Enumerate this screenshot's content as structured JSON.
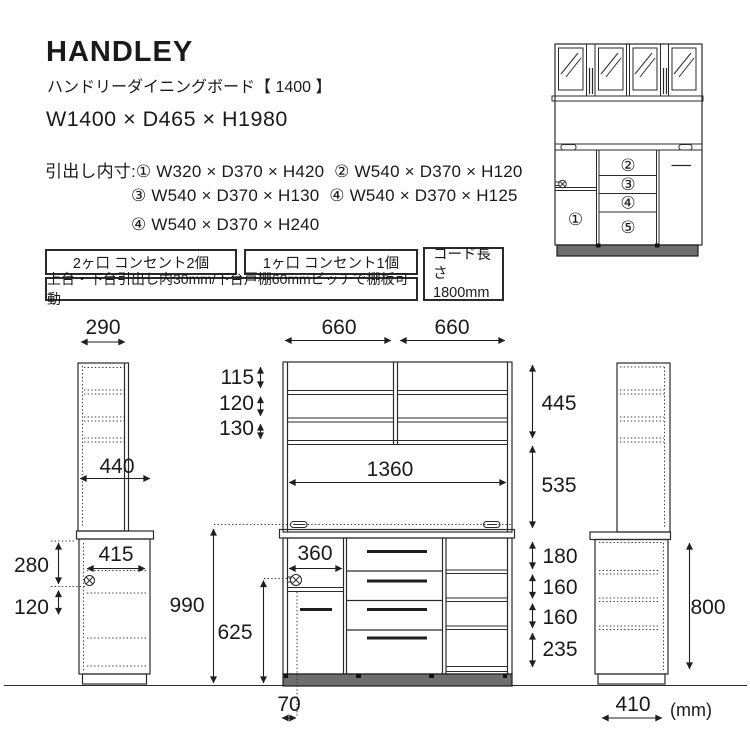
{
  "header": {
    "title": "HANDLEY",
    "subtitle": "ハンドリーダイニングボード【 1400 】",
    "size": "W1400 × D465 × H1980"
  },
  "specs": {
    "line1": "引出し内寸:① W320 × D370 × H420  ② W540 × D370 × H120",
    "line2": "③ W540 × D370 × H130  ④ W540 × D370 × H125",
    "line3": "④ W540 × D370 × H240"
  },
  "notes": {
    "outlet2": "2ヶ口 コンセント2個",
    "outlet1": "1ヶ口 コンセント1個",
    "pitch": "上台・下台引出し内30mm/下台戸棚60mmピッチで棚板可動",
    "cord_label": "コード長さ",
    "cord_value": "1800mm"
  },
  "mini": {
    "n1": "①",
    "n2": "②",
    "n3": "③",
    "n4": "④",
    "n5": "⑤"
  },
  "dims": {
    "w290": "290",
    "w440": "440",
    "w415": "415",
    "h280": "280",
    "h120side": "120",
    "h990": "990",
    "h625": "625",
    "w660l": "660",
    "w660r": "660",
    "h115": "115",
    "h120": "120",
    "h130": "130",
    "w1360": "1360",
    "w360": "360",
    "w70": "70",
    "h445": "445",
    "h535": "535",
    "h180": "180",
    "h160a": "160",
    "h160b": "160",
    "h235": "235",
    "h800": "800",
    "w410": "410",
    "unit": "(mm)"
  }
}
